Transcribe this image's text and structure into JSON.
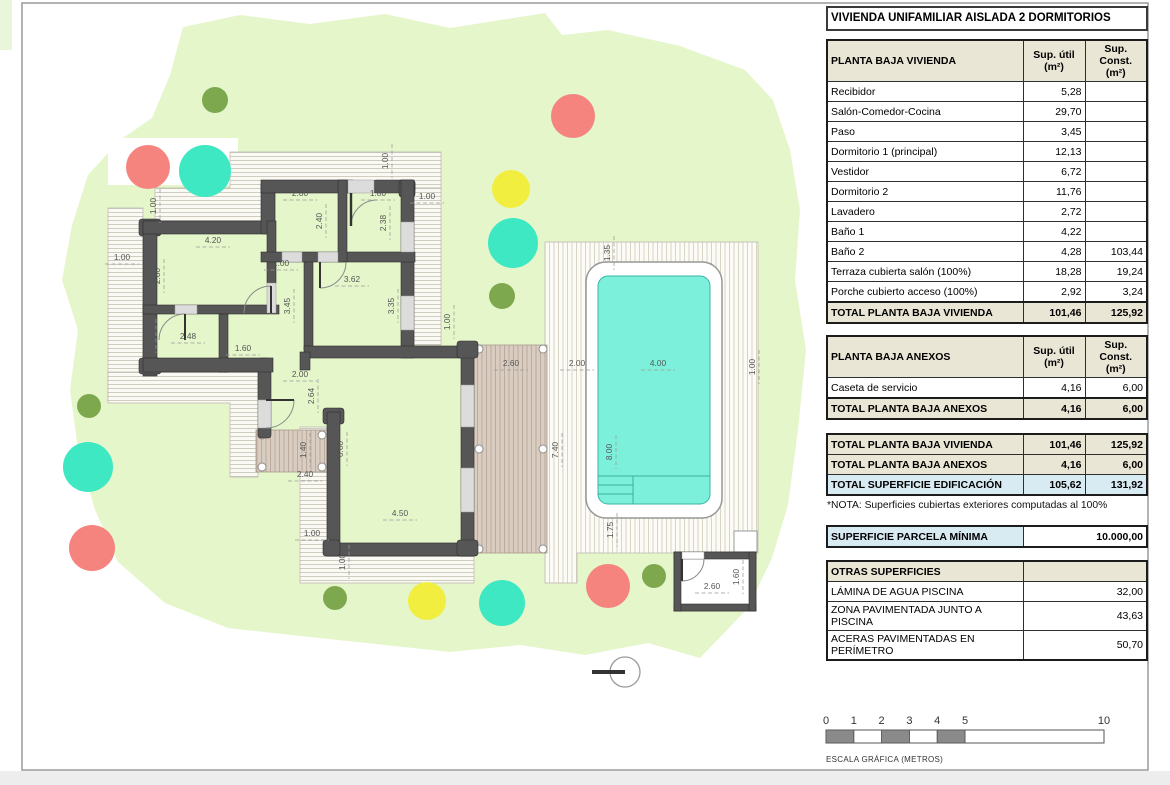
{
  "title": "VIVIENDA UNIFAMILIAR AISLADA 2 DORMITORIOS",
  "columns": {
    "util": "Sup. útil",
    "konst": "Sup. Const.",
    "unit": "(m²)"
  },
  "vivienda": {
    "header": "PLANTA BAJA VIVIENDA",
    "rows": [
      {
        "label": "Recibidor",
        "util": "5,28",
        "konst": ""
      },
      {
        "label": "Salón-Comedor-Cocina",
        "util": "29,70",
        "konst": ""
      },
      {
        "label": "Paso",
        "util": "3,45",
        "konst": ""
      },
      {
        "label": "Dormitorio 1 (principal)",
        "util": "12,13",
        "konst": ""
      },
      {
        "label": "Vestidor",
        "util": "6,72",
        "konst": ""
      },
      {
        "label": "Dormitorio 2",
        "util": "11,76",
        "konst": ""
      },
      {
        "label": "Lavadero",
        "util": "2,72",
        "konst": ""
      },
      {
        "label": "Baño 1",
        "util": "4,22",
        "konst": ""
      },
      {
        "label": "Baño 2",
        "util": "4,28",
        "konst": "103,44"
      },
      {
        "label": "Terraza cubierta salón (100%)",
        "util": "18,28",
        "konst": "19,24"
      },
      {
        "label": "Porche cubierto acceso (100%)",
        "util": "2,92",
        "konst": "3,24"
      }
    ],
    "total": {
      "label": "TOTAL PLANTA BAJA VIVIENDA",
      "util": "101,46",
      "konst": "125,92"
    }
  },
  "anexos": {
    "header": "PLANTA BAJA ANEXOS",
    "rows": [
      {
        "label": "Caseta de servicio",
        "util": "4,16",
        "konst": "6,00"
      }
    ],
    "total": {
      "label": "TOTAL PLANTA BAJA ANEXOS",
      "util": "4,16",
      "konst": "6,00"
    }
  },
  "resumen": {
    "rows": [
      {
        "label": "TOTAL PLANTA BAJA VIVIENDA",
        "util": "101,46",
        "konst": "125,92",
        "hl": "beige"
      },
      {
        "label": "TOTAL PLANTA BAJA ANEXOS",
        "util": "4,16",
        "konst": "6,00",
        "hl": "beige"
      },
      {
        "label": "TOTAL SUPERFICIE EDIFICACIÓN",
        "util": "105,62",
        "konst": "131,92",
        "hl": "blue"
      }
    ]
  },
  "nota": "*NOTA: Superficies cubiertas exteriores computadas al 100%",
  "parcela": {
    "label": "SUPERFICIE PARCELA MÍNIMA",
    "value": "10.000,00"
  },
  "otras": {
    "header": "OTRAS SUPERFICIES",
    "rows": [
      {
        "label": "LÁMINA DE AGUA PISCINA",
        "value": "32,00"
      },
      {
        "label": "ZONA PAVIMENTADA JUNTO A PISCINA",
        "value": "43,63"
      },
      {
        "label": "ACERAS PAVIMENTADAS EN PERÍMETRO",
        "value": "50,70"
      }
    ]
  },
  "plan": {
    "colors": {
      "wall": "#565656",
      "parcel": "#e5f6cb",
      "pool_water": "#7df0db",
      "pool_edge": "#35b5a5",
      "beige": "#eae6d6",
      "lightblue": "#d8eaf2",
      "tree_red": "#f5847e",
      "tree_teal": "#3de8c2",
      "tree_yellow": "#f2ee3f",
      "tree_olive": "#7ea84e"
    },
    "dimensions": [
      {
        "t": "4.20",
        "x": 213,
        "y": 243,
        "o": "h"
      },
      {
        "t": "2.80",
        "x": 300,
        "y": 196,
        "o": "h"
      },
      {
        "t": "1.80",
        "x": 378,
        "y": 196,
        "o": "h"
      },
      {
        "t": "1.00",
        "x": 427,
        "y": 199,
        "o": "h"
      },
      {
        "t": "2.40",
        "x": 322,
        "y": 221,
        "o": "v"
      },
      {
        "t": "2.38",
        "x": 386,
        "y": 223,
        "o": "v"
      },
      {
        "t": "1.00",
        "x": 388,
        "y": 161,
        "o": "v"
      },
      {
        "t": "2.80",
        "x": 160,
        "y": 276,
        "o": "v"
      },
      {
        "t": "1.00",
        "x": 281,
        "y": 266,
        "o": "h"
      },
      {
        "t": "3.62",
        "x": 352,
        "y": 282,
        "o": "h"
      },
      {
        "t": "3.45",
        "x": 290,
        "y": 306,
        "o": "v"
      },
      {
        "t": "3.35",
        "x": 394,
        "y": 306,
        "o": "v"
      },
      {
        "t": "2.48",
        "x": 188,
        "y": 339,
        "o": "h"
      },
      {
        "t": "1.60",
        "x": 243,
        "y": 351,
        "o": "h"
      },
      {
        "t": "1.70",
        "x": 152,
        "y": 336,
        "o": "v"
      },
      {
        "t": "2.00",
        "x": 300,
        "y": 377,
        "o": "h"
      },
      {
        "t": "2.64",
        "x": 314,
        "y": 396,
        "o": "v"
      },
      {
        "t": "1.40",
        "x": 306,
        "y": 450,
        "o": "v"
      },
      {
        "t": "2.40",
        "x": 305,
        "y": 477,
        "o": "h"
      },
      {
        "t": "6.60",
        "x": 343,
        "y": 449,
        "o": "v"
      },
      {
        "t": "4.50",
        "x": 400,
        "y": 516,
        "o": "h"
      },
      {
        "t": "1.00",
        "x": 312,
        "y": 536,
        "o": "h"
      },
      {
        "t": "1.00",
        "x": 345,
        "y": 562,
        "o": "v"
      },
      {
        "t": "1.00",
        "x": 122,
        "y": 260,
        "o": "h"
      },
      {
        "t": "1.00",
        "x": 156,
        "y": 206,
        "o": "v"
      },
      {
        "t": "1.00",
        "x": 450,
        "y": 322,
        "o": "v"
      },
      {
        "t": "2.60",
        "x": 511,
        "y": 366,
        "o": "h"
      },
      {
        "t": "2.00",
        "x": 577,
        "y": 366,
        "o": "h"
      },
      {
        "t": "4.00",
        "x": 658,
        "y": 366,
        "o": "h"
      },
      {
        "t": "7.40",
        "x": 558,
        "y": 450,
        "o": "v"
      },
      {
        "t": "8.00",
        "x": 612,
        "y": 452,
        "o": "v"
      },
      {
        "t": "1.35",
        "x": 610,
        "y": 253,
        "o": "v"
      },
      {
        "t": "1.75",
        "x": 613,
        "y": 530,
        "o": "v"
      },
      {
        "t": "2.60",
        "x": 712,
        "y": 589,
        "o": "h"
      },
      {
        "t": "1.60",
        "x": 739,
        "y": 577,
        "o": "v"
      },
      {
        "t": "1.00",
        "x": 755,
        "y": 367,
        "o": "v"
      }
    ],
    "trees": [
      {
        "x": 215,
        "y": 100,
        "r": 13,
        "c": "tree_olive"
      },
      {
        "x": 148,
        "y": 167,
        "r": 22,
        "c": "tree_red"
      },
      {
        "x": 205,
        "y": 171,
        "r": 26,
        "c": "tree_teal"
      },
      {
        "x": 573,
        "y": 116,
        "r": 22,
        "c": "tree_red"
      },
      {
        "x": 511,
        "y": 189,
        "r": 19,
        "c": "tree_yellow"
      },
      {
        "x": 513,
        "y": 243,
        "r": 25,
        "c": "tree_teal"
      },
      {
        "x": 502,
        "y": 296,
        "r": 13,
        "c": "tree_olive"
      },
      {
        "x": 89,
        "y": 406,
        "r": 12,
        "c": "tree_olive"
      },
      {
        "x": 88,
        "y": 467,
        "r": 25,
        "c": "tree_teal"
      },
      {
        "x": 92,
        "y": 548,
        "r": 23,
        "c": "tree_red"
      },
      {
        "x": 335,
        "y": 598,
        "r": 12,
        "c": "tree_olive"
      },
      {
        "x": 427,
        "y": 601,
        "r": 19,
        "c": "tree_yellow"
      },
      {
        "x": 502,
        "y": 603,
        "r": 23,
        "c": "tree_teal"
      },
      {
        "x": 608,
        "y": 586,
        "r": 22,
        "c": "tree_red"
      },
      {
        "x": 654,
        "y": 576,
        "r": 12,
        "c": "tree_olive"
      }
    ]
  },
  "scale_bar": {
    "x": 826,
    "y": 730,
    "height": 13,
    "px_per_m": 27.8,
    "ticks": [
      {
        "m": 0,
        "label": "0"
      },
      {
        "m": 1,
        "label": "1"
      },
      {
        "m": 2,
        "label": "2"
      },
      {
        "m": 3,
        "label": "3"
      },
      {
        "m": 4,
        "label": "4"
      },
      {
        "m": 5,
        "label": "5"
      },
      {
        "m": 10,
        "label": "10"
      }
    ],
    "filled": [
      [
        0,
        1
      ],
      [
        2,
        3
      ],
      [
        4,
        5
      ]
    ],
    "caption": "ESCALA GRÁFICA (METROS)"
  }
}
